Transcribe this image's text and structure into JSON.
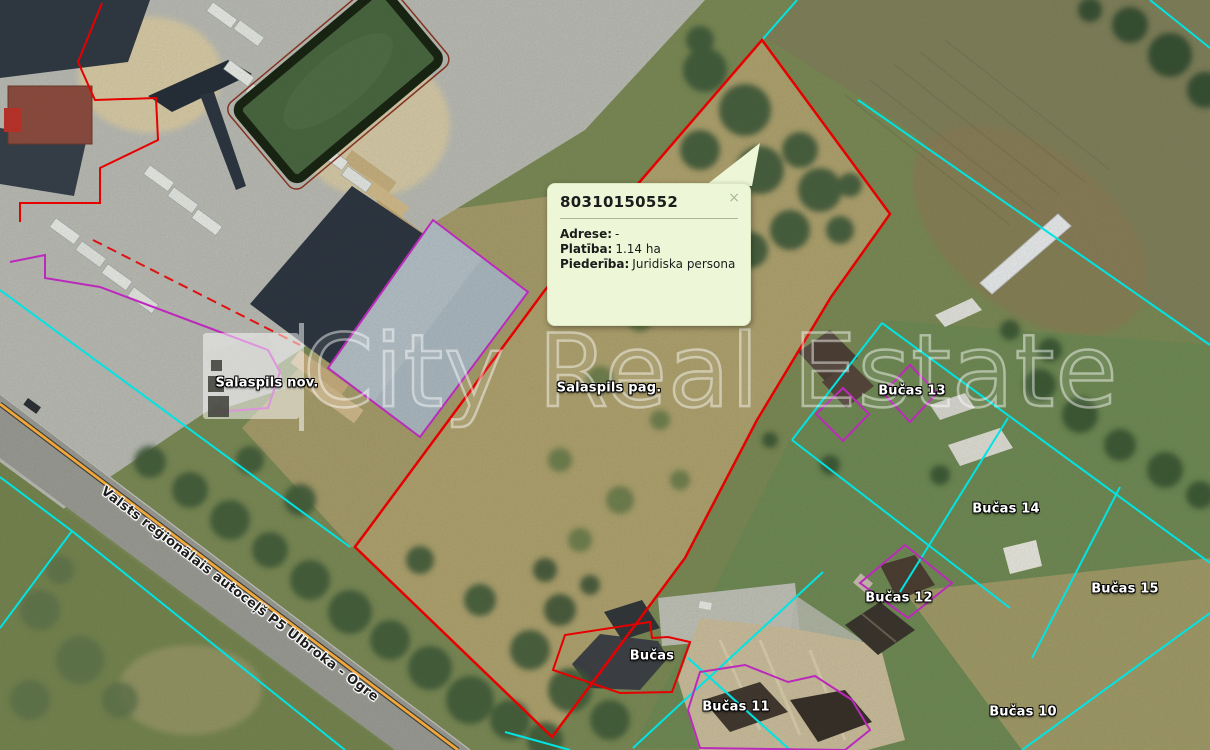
{
  "map": {
    "popup": {
      "title": "80310150552",
      "close_label": "×",
      "fields": [
        {
          "label": "Adrese:",
          "value": "-"
        },
        {
          "label": "Platība:",
          "value": "1.14 ha"
        },
        {
          "label": "Piederība:",
          "value": "Juridiska persona"
        }
      ]
    },
    "labels": {
      "municipality": "Salaspils nov.",
      "parish": "Salaspils pag.",
      "parcels": [
        "Bučas 13",
        "Bučas 14",
        "Bučas 15",
        "Bučas 12",
        "Bučas",
        "Bučas 11",
        "Bučas 10"
      ]
    },
    "road_label": "Valsts reģionālais autoceļš P5 Ulbroka - Ogre",
    "watermark": "City Real Estate",
    "colors": {
      "selected_parcel": "#e60000",
      "cadastre_boundary": "#00e4e4",
      "building_outline": "#bb2abb",
      "road_centerline": "#f2a73a",
      "popup_background": "#edf7d7"
    }
  }
}
